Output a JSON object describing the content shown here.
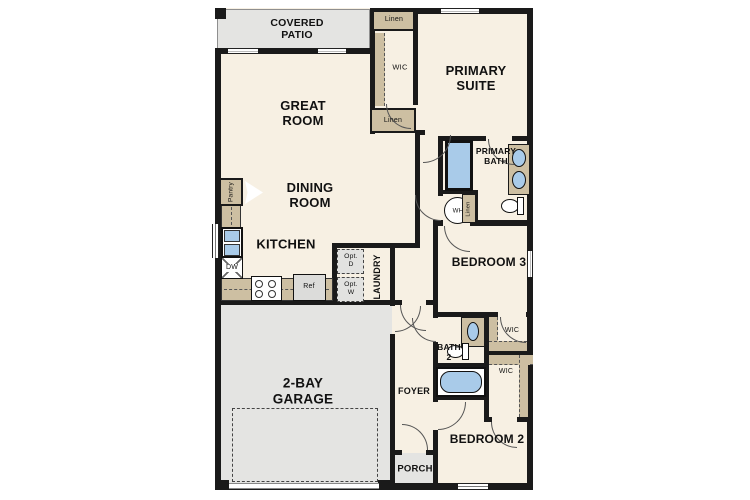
{
  "plan_title": "single-story-floor-plan",
  "rooms": {
    "covered_patio": "COVERED\nPATIO",
    "great_room": "GREAT\nROOM",
    "primary_suite": "PRIMARY\nSUITE",
    "dining_room": "DINING\nROOM",
    "kitchen": "KITCHEN",
    "laundry": "LAUNDRY",
    "primary_bath": "PRIMARY\nBATH",
    "bedroom3": "BEDROOM 3",
    "bath2": "BATH\n2",
    "foyer": "FOYER",
    "garage": "2-BAY\nGARAGE",
    "bedroom2": "BEDROOM 2",
    "porch": "PORCH"
  },
  "closets": {
    "linen_top": "Linen",
    "linen_mid": "Linen",
    "linen_bath": "Linen",
    "wic_primary": "WIC",
    "wic_bed3": "WIC",
    "wic_bed2": "WIC",
    "pantry": "Pantry"
  },
  "appliances": {
    "dishwasher": "DW",
    "refrigerator": "Ref",
    "opt_dryer": "Opt.\nD",
    "opt_washer": "Opt.\nW",
    "water_heater": "WH"
  },
  "colors": {
    "floor": "#f7f0e3",
    "outdoor": "#e4e4e2",
    "wall": "#1a1a1a",
    "cabinet": "#cdbfa2",
    "fixture_blue": "#a9cbe9",
    "appliance_gray": "#dcdcda"
  }
}
